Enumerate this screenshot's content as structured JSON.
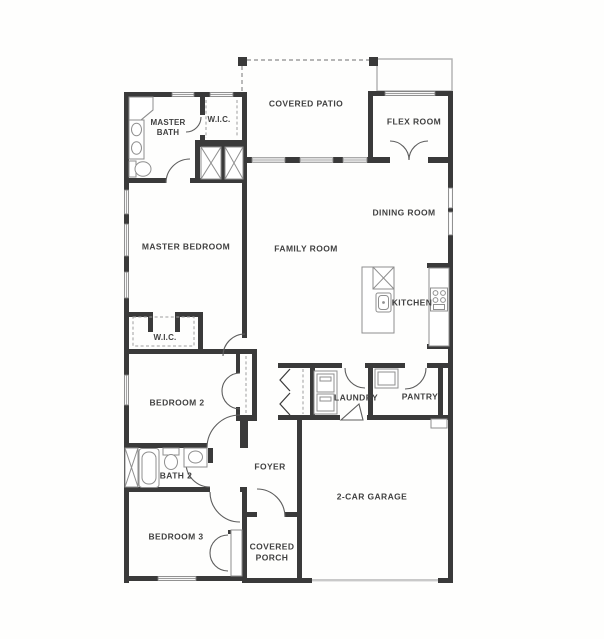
{
  "plan": {
    "type": "residential-floor-plan",
    "colors": {
      "wall": "#3a3a3a",
      "thin_line": "#8f8f8f",
      "dash_line": "#9e9e9e",
      "text": "#414141",
      "background": "#fefefd"
    },
    "rooms": [
      {
        "id": "master-bath",
        "label": "MASTER\nBATH",
        "x": 168,
        "y": 128
      },
      {
        "id": "wic-master",
        "label": "W.I.C.",
        "x": 219,
        "y": 120
      },
      {
        "id": "covered-patio",
        "label": "COVERED PATIO",
        "x": 306,
        "y": 104
      },
      {
        "id": "flex-room",
        "label": "FLEX ROOM",
        "x": 414,
        "y": 122
      },
      {
        "id": "dining-room",
        "label": "DINING ROOM",
        "x": 404,
        "y": 213
      },
      {
        "id": "master-bedroom",
        "label": "MASTER BEDROOM",
        "x": 186,
        "y": 247
      },
      {
        "id": "family-room",
        "label": "FAMILY ROOM",
        "x": 306,
        "y": 249
      },
      {
        "id": "kitchen",
        "label": "KITCHEN",
        "x": 412,
        "y": 303
      },
      {
        "id": "wic-2",
        "label": "W.I.C.",
        "x": 165,
        "y": 338
      },
      {
        "id": "bedroom-2",
        "label": "BEDROOM 2",
        "x": 177,
        "y": 403
      },
      {
        "id": "laundry",
        "label": "LAUNDRY",
        "x": 356,
        "y": 398
      },
      {
        "id": "pantry",
        "label": "PANTRY",
        "x": 420,
        "y": 397
      },
      {
        "id": "bath-2",
        "label": "BATH 2",
        "x": 176,
        "y": 476
      },
      {
        "id": "foyer",
        "label": "FOYER",
        "x": 270,
        "y": 467
      },
      {
        "id": "bedroom-3",
        "label": "BEDROOM 3",
        "x": 176,
        "y": 537
      },
      {
        "id": "covered-porch",
        "label": "COVERED\nPORCH",
        "x": 272,
        "y": 552
      },
      {
        "id": "garage",
        "label": "2-CAR GARAGE",
        "x": 372,
        "y": 497
      }
    ]
  }
}
